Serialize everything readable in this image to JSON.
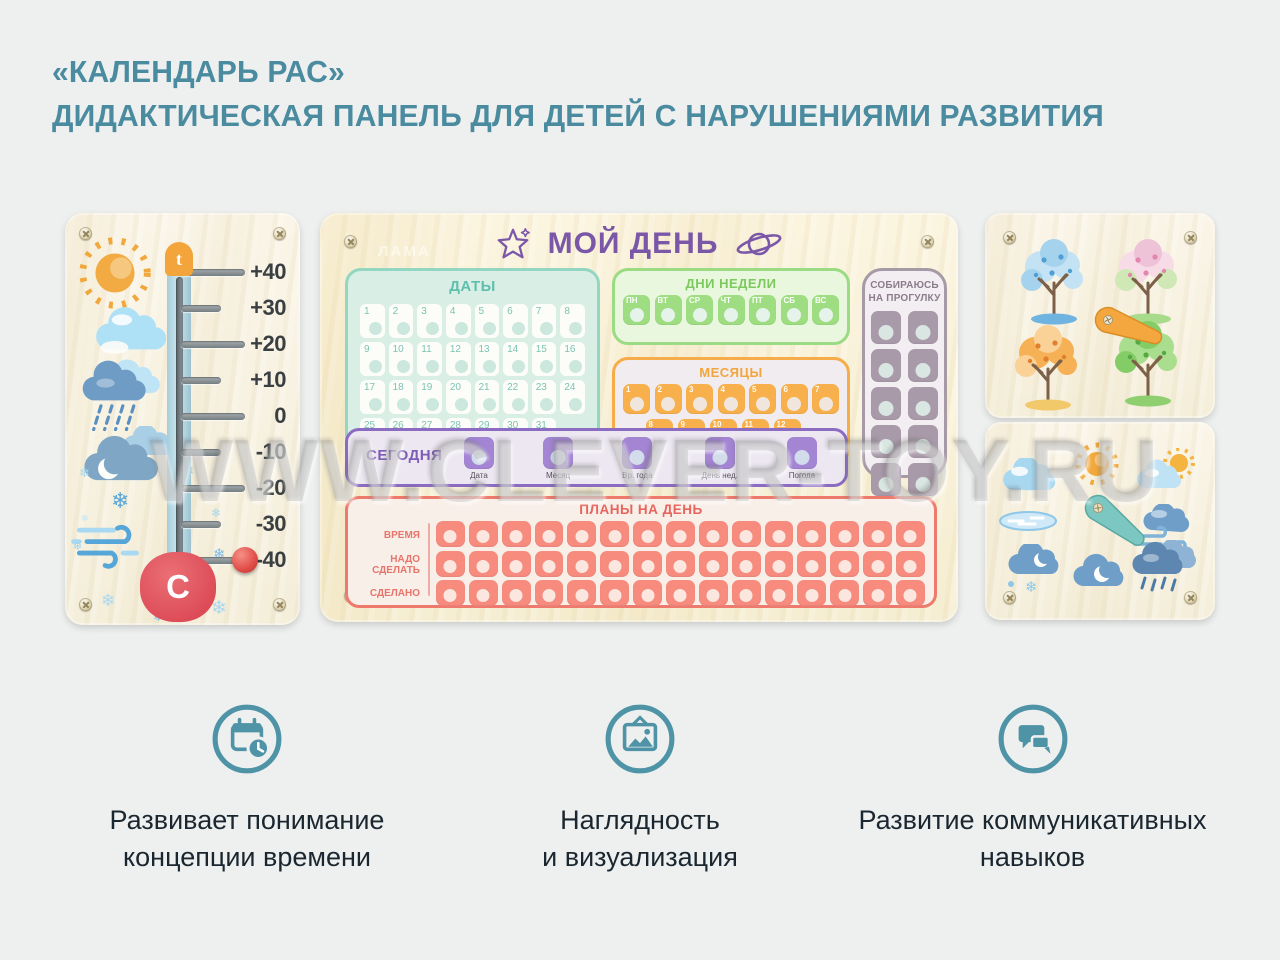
{
  "header": {
    "line1": "«КАЛЕНДАРЬ РАС»",
    "line2": "ДИДАКТИЧЕСКАЯ ПАНЕЛЬ ДЛЯ ДЕТЕЙ С НАРУШЕНИЯМИ РАЗВИТИЯ"
  },
  "colors": {
    "accent_teal": "#4a8ba0",
    "icon_teal": "#4f93a7",
    "purple": "#7b57a8",
    "green": "#7cc95e",
    "orange": "#f3a53d",
    "mint": "#5fbfae",
    "red": "#e8635c",
    "gray_purple": "#8b7d8b",
    "wood": "#f8f2de"
  },
  "watermark": {
    "text": "WWW.CLEVER-TOY.RU"
  },
  "thermometer": {
    "top_symbol": "t",
    "bottom_symbol": "C",
    "snowflake_glyph": "❄",
    "scale": [
      "+40",
      "+30",
      "+20",
      "+10",
      "0",
      "-10",
      "-20",
      "-30",
      "-40"
    ],
    "knob_position": "-40",
    "weather_icons": [
      "sun",
      "cloud",
      "rain-cloud",
      "clouds",
      "wind",
      "snowflakes"
    ]
  },
  "my_day": {
    "title": "МОЙ ДЕНЬ",
    "brand_watermark": "ЛАМА",
    "header_icons": [
      "star",
      "saturn"
    ],
    "dates": {
      "title": "ДАТЫ",
      "numbers": [
        "1",
        "2",
        "3",
        "4",
        "5",
        "6",
        "7",
        "8",
        "9",
        "10",
        "11",
        "12",
        "13",
        "14",
        "15",
        "16",
        "17",
        "18",
        "19",
        "20",
        "21",
        "22",
        "23",
        "24",
        "25",
        "26",
        "27",
        "28",
        "29",
        "30",
        "31"
      ]
    },
    "weekdays": {
      "title": "ДНИ НЕДЕЛИ",
      "days": [
        "ПН",
        "ВТ",
        "СР",
        "ЧТ",
        "ПТ",
        "СБ",
        "ВС"
      ]
    },
    "months": {
      "title": "МЕСЯЦЫ",
      "row1": [
        "1",
        "2",
        "3",
        "4",
        "5",
        "6",
        "7"
      ],
      "row2": [
        "8",
        "9",
        "10",
        "11",
        "12"
      ]
    },
    "walk": {
      "title_line1": "СОБИРАЮСЬ",
      "title_line2": "НА ПРОГУЛКУ",
      "slots": 10
    },
    "today": {
      "label": "СЕГОДНЯ",
      "slots": [
        "Дата",
        "Месяц",
        "Вр. года",
        "День нед.",
        "Погода"
      ]
    },
    "plans": {
      "title": "ПЛАНЫ НА ДЕНЬ",
      "rows": [
        "ВРЕМЯ",
        "НАДО СДЕЛАТЬ",
        "СДЕЛАНО"
      ],
      "cells_per_row": 15
    }
  },
  "seasons_board": {
    "icons": [
      "winter-tree",
      "spring-tree",
      "autumn-tree",
      "summer-tree",
      "rotating-pointer"
    ]
  },
  "weather_board": {
    "icons": [
      "cloud",
      "sun",
      "sun-behind-cloud",
      "puddle",
      "rotating-pointer",
      "windy-cloud",
      "snow-cloud-moon",
      "cloud-moon",
      "rain-cloud"
    ]
  },
  "features": [
    {
      "icon": "calendar-clock-icon",
      "line1": "Развивает понимание",
      "line2": "концепции времени"
    },
    {
      "icon": "picture-icon",
      "line1": "Наглядность",
      "line2": "и визуализация"
    },
    {
      "icon": "chat-icon",
      "line1": "Развитие коммуникативных",
      "line2": "навыков"
    }
  ]
}
